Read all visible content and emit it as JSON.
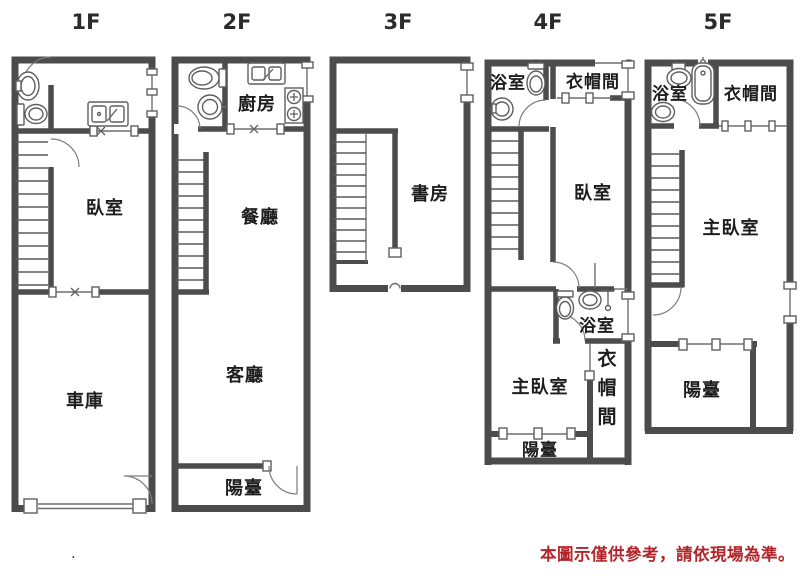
{
  "colors": {
    "wall": "#4c4c4c",
    "thin_line": "#6f6f6f",
    "text": "#1d1d1d",
    "disclaimer_red": "#b4252a"
  },
  "floors": {
    "f1": {
      "label": "1F",
      "bedroom": "臥室",
      "garage": "車庫"
    },
    "f2": {
      "label": "2F",
      "kitchen": "廚房",
      "dining": "餐廳",
      "living": "客廳",
      "balcony": "陽臺"
    },
    "f3": {
      "label": "3F",
      "study": "書房"
    },
    "f4": {
      "label": "4F",
      "bath_top": "浴室",
      "closet_top": "衣帽間",
      "bedroom": "臥室",
      "bath_mid": "浴室",
      "closet_mid": "衣帽間",
      "master": "主臥室",
      "balcony": "陽臺"
    },
    "f5": {
      "label": "5F",
      "bath": "浴室",
      "closet": "衣帽間",
      "master": "主臥室",
      "balcony": "陽臺"
    }
  },
  "disclaimer": "本圖示僅供參考，請依現場為準。",
  "footnote_dot": "."
}
